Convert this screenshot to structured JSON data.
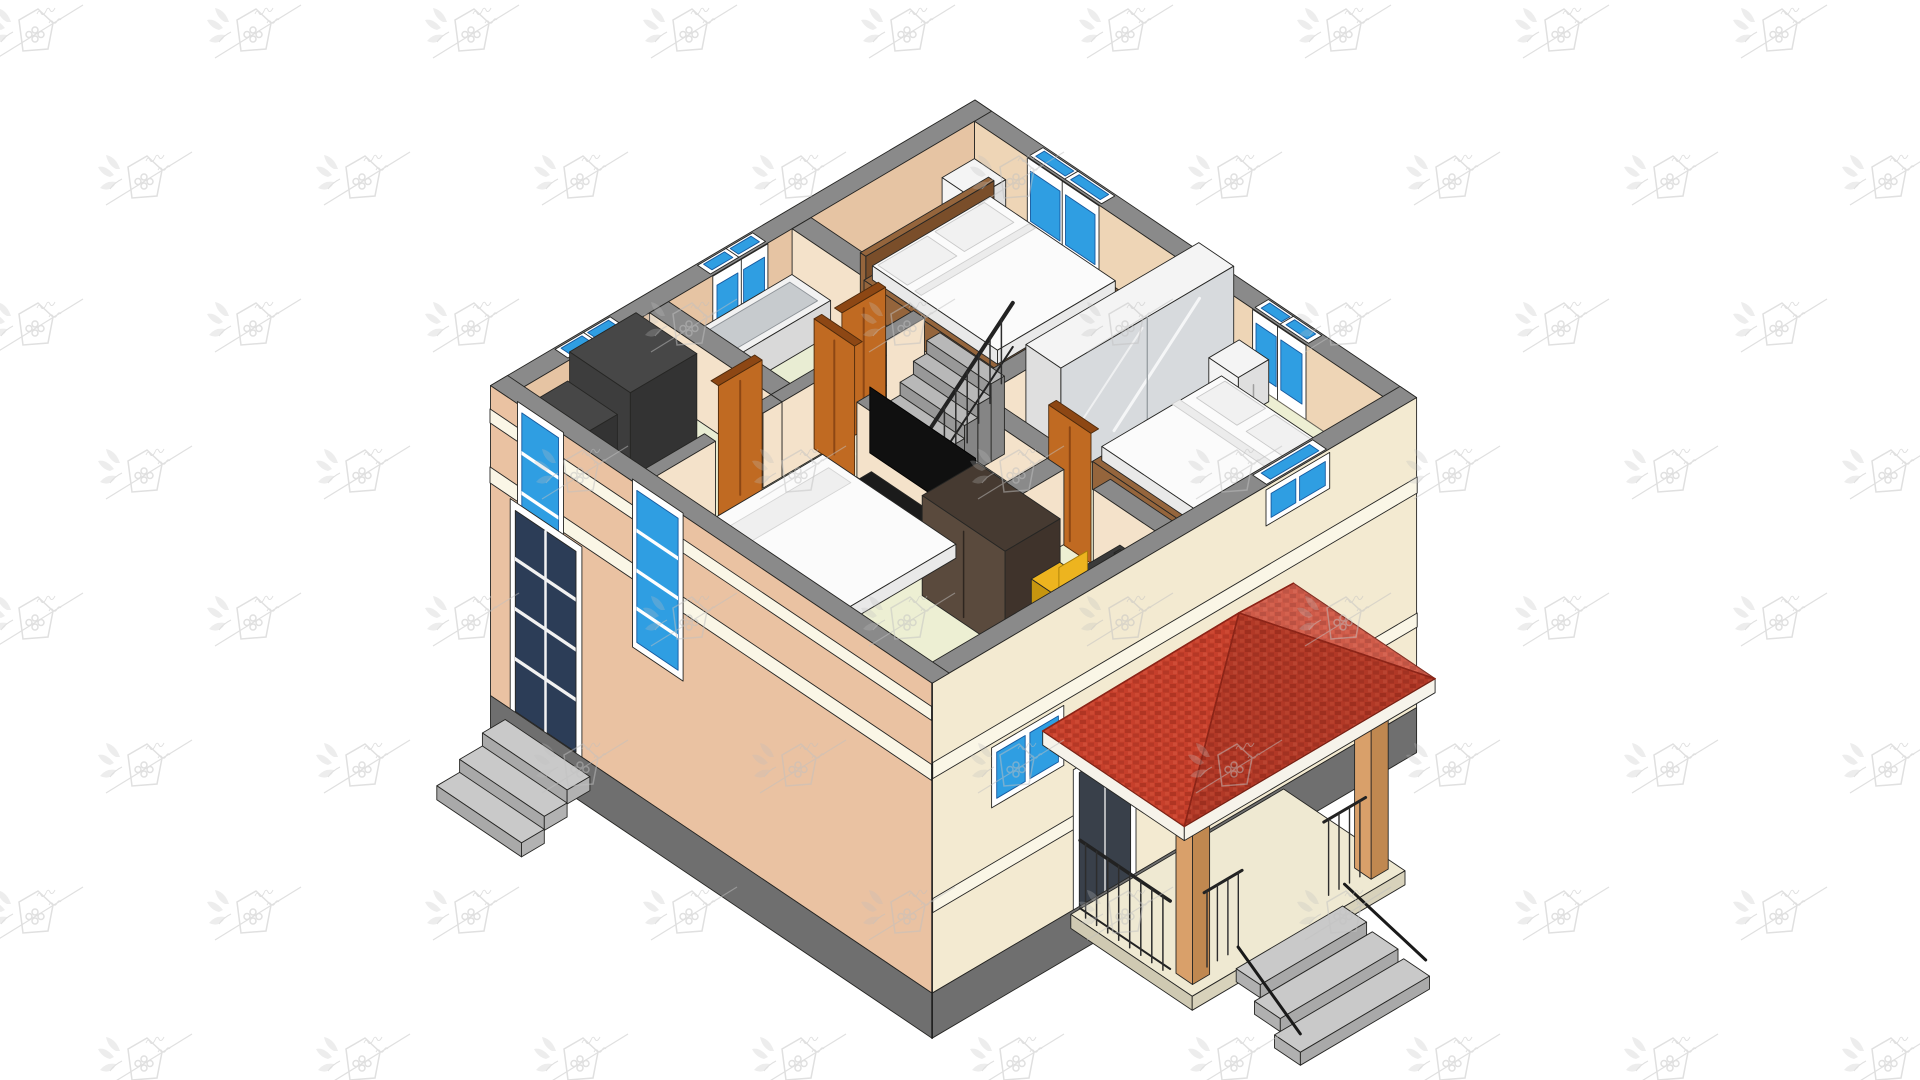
{
  "meta": {
    "description": "3D isometric cutaway rendering of a house upper floor plan with furniture, red hip porch roof and entrance steps, tiled with a faint logo watermark",
    "background": "#ffffff",
    "canvas": {
      "width": 1920,
      "height": 1080
    }
  },
  "watermark": {
    "icon": "house-leaf-logo-watermark",
    "color": "#c0c0c0",
    "opacity": 0.5,
    "rows": 8,
    "cols": 10,
    "x_step": 218,
    "y_step": 147,
    "row_offset": 109,
    "x_start": -15,
    "y_start": -8
  },
  "palette": {
    "wallTop": "#8a8a8a",
    "wallEdge": "#262624",
    "innerNE": "#eed5b6",
    "innerNW": "#e6c4a3",
    "innerPartition": "#f4e2ca",
    "white": "#ffffff",
    "floorBed": "#edefd3",
    "floorHall": "#f4efd9",
    "floorBath": "#e9edd3",
    "exteriorSE": "#f3ead1",
    "exteriorSW": "#eac2a2",
    "band": "#faf6e6",
    "plinth": "#6f6f6f",
    "windowBlue": "#2f9ee2",
    "windowBlueDark": "#16599f",
    "doorNavy": "#2c3d57",
    "woodDoor": "#c06a22",
    "woodDoorDark": "#8d4714",
    "stairTread": "#b8b8b8",
    "stairRiser": "#989898",
    "stairSide": "#858585",
    "railing": "#262626",
    "mattress": "#fbfbfb",
    "mattressSide": "#e9e9e9",
    "pillow": "#f1f1f1",
    "bedWood": "#95653c",
    "bedWoodDark": "#7a4e2a",
    "furnWhite": "#f4f4f4",
    "furnWhiteSide": "#dfdfdf",
    "mirror": "#d7dadd",
    "darkWardrobe": "#463a31",
    "darkWardrobeFront": "#5a4a3d",
    "deskDark": "#3a3a3a",
    "chairYellow": "#edb41f",
    "tvBlack": "#101010",
    "tubOuter": "#d9d9d9",
    "tubRim": "#f2f2f2",
    "tubInner": "#c7cbce",
    "cabinetDark": "#474747",
    "cabinetDarker": "#333333",
    "roofRed": "#c63f2b",
    "roofRedDark": "#992c1c",
    "roofRedLight": "#d85a43",
    "fascia": "#f6f3ea",
    "post": "#d9a06a",
    "postShade": "#c08850",
    "stepGrey": "#c9c9c9",
    "stepSide": "#a9a9a9",
    "porchFloor": "#efe9d2",
    "refLine": "#fdfbe2"
  },
  "scene": {
    "projection": "isometric-cutaway",
    "storey": "upper-floor-exposed",
    "rooms": [
      "bedroom-back",
      "bedroom-master",
      "bedroom-front",
      "bathroom",
      "storage-room",
      "hallway-with-stairs"
    ],
    "furniture": [
      "double-bed",
      "master-bed",
      "floor-mattress",
      "mirrored-wardrobe",
      "dark-wardrobe",
      "nightstands",
      "bathtub",
      "toilet",
      "vanity",
      "stairs-with-railing",
      "wall-tv",
      "tv-console",
      "desk",
      "laptop",
      "yellow-chair",
      "dark-cabinets"
    ],
    "exterior": [
      "porch-red-hip-roof",
      "porch-posts",
      "porch-railing",
      "entrance-steps",
      "side-door-steps",
      "blue-windows",
      "side-glazed-door",
      "entrance-door",
      "plinth",
      "facade-bands"
    ]
  }
}
